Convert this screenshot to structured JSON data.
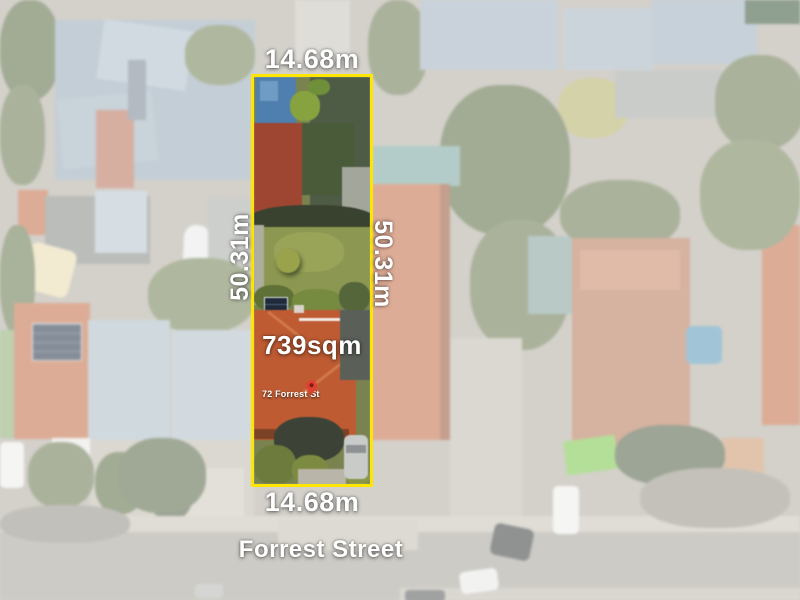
{
  "property": {
    "width_top_label": "14.68m",
    "width_bottom_label": "14.68m",
    "depth_left_label": "50.31m",
    "depth_right_label": "50.31m",
    "area_label": "739sqm",
    "address_label": "72 Forrest St"
  },
  "street": {
    "name_label": "Forrest Street"
  },
  "icons": {
    "address_pin": "map-pin"
  },
  "colors": {
    "boundary": "#ffe600",
    "label_text": "#ffffff",
    "pin_red": "#e0402f"
  }
}
